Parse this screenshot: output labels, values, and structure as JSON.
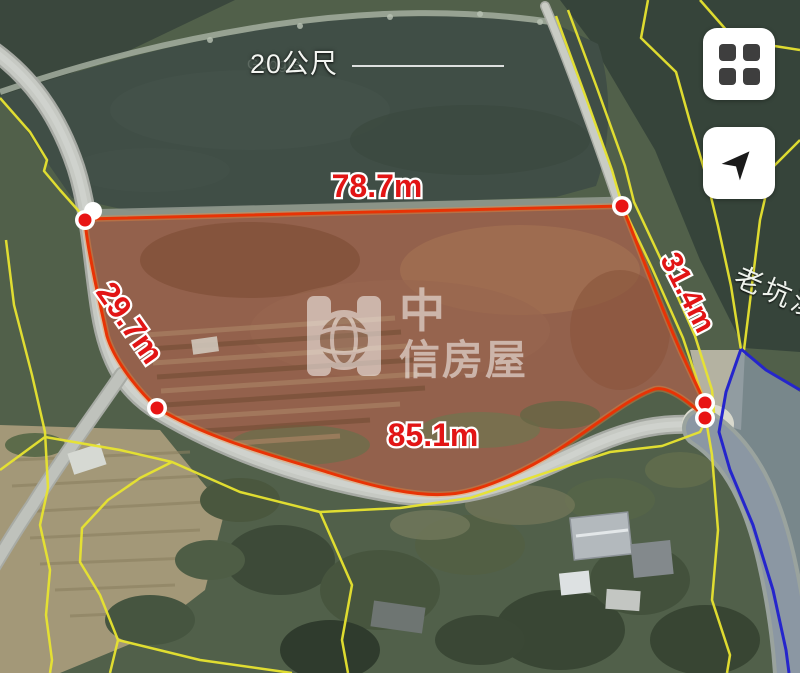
{
  "scale_bar": {
    "label": "20公尺"
  },
  "attribution": {
    "text": "Google"
  },
  "watermark": {
    "brand_top": "中",
    "brand_bottom": "信房屋",
    "brand_full": "中信房屋"
  },
  "place_label": {
    "text": "老坑溪"
  },
  "parcel": {
    "measurements": {
      "top": "78.7m",
      "right": "31.4m",
      "bottom": "85.1m",
      "left": "29.7m"
    },
    "outline_color": "#e83305",
    "vertex_color": "#e81414",
    "fill_color": "#8e6350"
  },
  "overlay_colors": {
    "cadastral_line": "#e8e430",
    "adjacent_parcel_line": "#2525cc"
  },
  "controls": {
    "tiles_icon": "grid-view",
    "locate_icon": "my-location-arrow"
  }
}
